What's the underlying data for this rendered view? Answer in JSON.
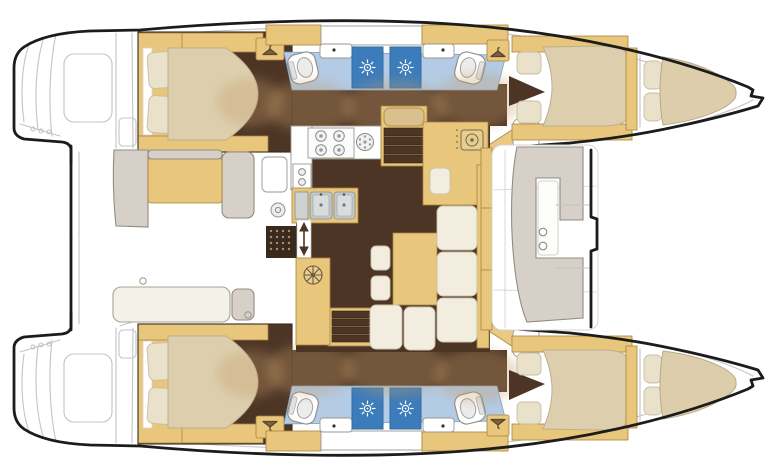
{
  "page": {
    "background": "#ffffff",
    "kind": "catamaran-interior-floor-plan"
  },
  "palette": {
    "page-bg": "#ffffff",
    "hull-line": "#1c1c1c",
    "faint-line": "#c4c4c4",
    "floor-dark": "#4d3526",
    "wood": "#e8c77d",
    "wood-outline": "#a9823f",
    "wood-pale": "#d9c08c",
    "mattress": "#ddcfae",
    "pillow": "#eae1cb",
    "cushion": "#f2edde",
    "bench-gray": "#d6d0c8",
    "bench-outline": "#908c84",
    "bath-floor-blue": "#b3cbe4",
    "shower-blue": "#3d7cba",
    "metal": "#c3c7c7",
    "door-swing-beige": "#c59a66",
    "mat-brown": "#3a2a1d",
    "mat-dot": "#a4906c"
  },
  "icons": {
    "shower_rose": "white sunburst on blue shower stall",
    "hanger": "coat-hanger glyph on wardrobe locker",
    "toilet": "bowl with seat outline",
    "burner": "ring with centre dot",
    "fan_hatch": "circle with six spokes",
    "bar_sink": "rounded square with circular basin",
    "companionway_arrow": "vertical double-headed arrow",
    "entry_mat": "dark dotted rectangle"
  },
  "areas": [
    {
      "name": "port-hull"
    },
    {
      "name": "starboard-hull"
    },
    {
      "name": "port-aft-cabin"
    },
    {
      "name": "starboard-aft-cabin"
    },
    {
      "name": "port-head-shower"
    },
    {
      "name": "starboard-head-shower"
    },
    {
      "name": "port-forward-cabin"
    },
    {
      "name": "starboard-forward-cabin"
    },
    {
      "name": "port-forepeak-berth"
    },
    {
      "name": "starboard-forepeak-berth"
    },
    {
      "name": "galley"
    },
    {
      "name": "saloon-dinette"
    },
    {
      "name": "nav-bar-cabinet"
    },
    {
      "name": "aft-cockpit"
    },
    {
      "name": "forward-cockpit"
    }
  ]
}
